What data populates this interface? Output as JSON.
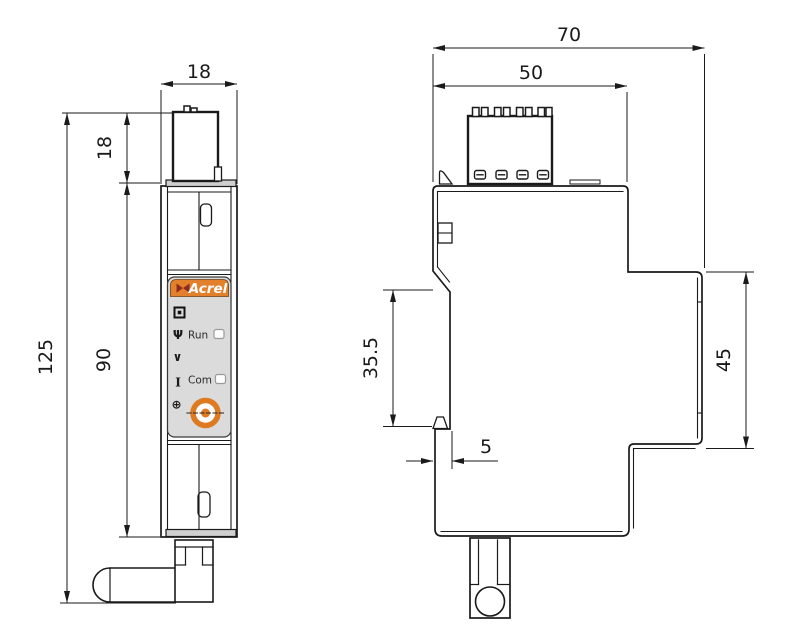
{
  "drawing": {
    "kind": "device dimensional drawing",
    "front_view": {
      "dim_width": "18",
      "dim_terminal_height": "18",
      "dim_total_height": "125",
      "dim_body_height": "90",
      "panel": {
        "brand": "Acrel",
        "run_label": "Run",
        "com_label": "Com",
        "icons": {
          "display": "▣",
          "wireless": "Ψ",
          "voltage": "∨",
          "current": "I",
          "terminal": "⊕"
        }
      }
    },
    "side_view": {
      "dim_total_width": "70",
      "dim_terminal_width": "50",
      "dim_rail_section_height": "35.5",
      "dim_front_section_height": "45",
      "dim_rail_depth": "5"
    },
    "colors": {
      "line": "#1a1a1a",
      "accent_orange": "#E2802C",
      "logo_red": "#8E2B21",
      "panel_gray": "#DBDBDB",
      "button_orange": "#DE7B20"
    }
  }
}
